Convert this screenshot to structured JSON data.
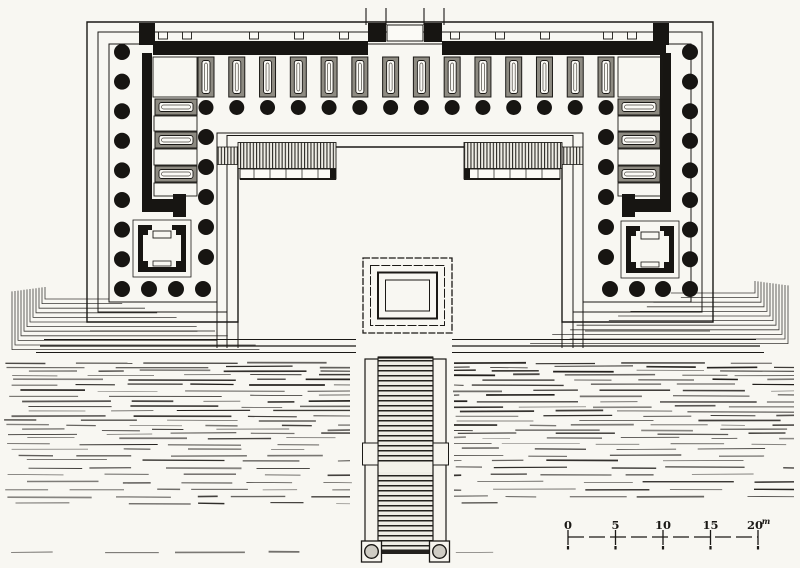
{
  "colors": {
    "paper": "#f8f7f2",
    "ink": "#1b1916",
    "pier_fill": "#8e8b82",
    "stair_tint": "#efede6"
  },
  "scale_bar": {
    "tick_labels": [
      "0",
      "5",
      "10",
      "15",
      "20"
    ],
    "unit": "m",
    "x_start": 568,
    "x_end": 758,
    "baseline_y": 537,
    "label_y": 529
  },
  "plan": {
    "column_radius": 7,
    "north_colonnade": {
      "count": 14,
      "x_start": 206,
      "spacing": 30.77,
      "y": 107.5
    },
    "north_piers": {
      "count": 14,
      "x_start": 206,
      "spacing": 30.77,
      "y": 57,
      "w": 16,
      "h": 40
    },
    "west_wing": {
      "outer_x": 122,
      "outer_y_start": 52,
      "outer_spacing": 29.6,
      "outer_count": 8,
      "inner_x": 206,
      "inner_ys": [
        137,
        167,
        197,
        227,
        257
      ],
      "south_row_y": 289,
      "south_xs": [
        122,
        149,
        176,
        203
      ],
      "pier_stack": [
        {
          "x": 155,
          "y": 99
        },
        {
          "x": 155,
          "y": 132
        },
        {
          "x": 155,
          "y": 166
        }
      ],
      "pier_w": 42,
      "pier_h": 16
    },
    "east_wing": {
      "outer_x": 690,
      "outer_y_start": 52,
      "outer_spacing": 29.6,
      "outer_count": 8,
      "inner_x": 606,
      "inner_ys": [
        137,
        167,
        197,
        227,
        257
      ],
      "south_row_y": 289,
      "south_xs": [
        610,
        637,
        663,
        690
      ],
      "pier_stack": [
        {
          "x": 618,
          "y": 99
        },
        {
          "x": 618,
          "y": 132
        },
        {
          "x": 618,
          "y": 166
        }
      ],
      "pier_w": 42,
      "pier_h": 16
    },
    "wall_joint_xs": [
      163,
      187,
      254,
      299,
      344,
      455,
      500,
      545,
      608,
      632
    ]
  }
}
